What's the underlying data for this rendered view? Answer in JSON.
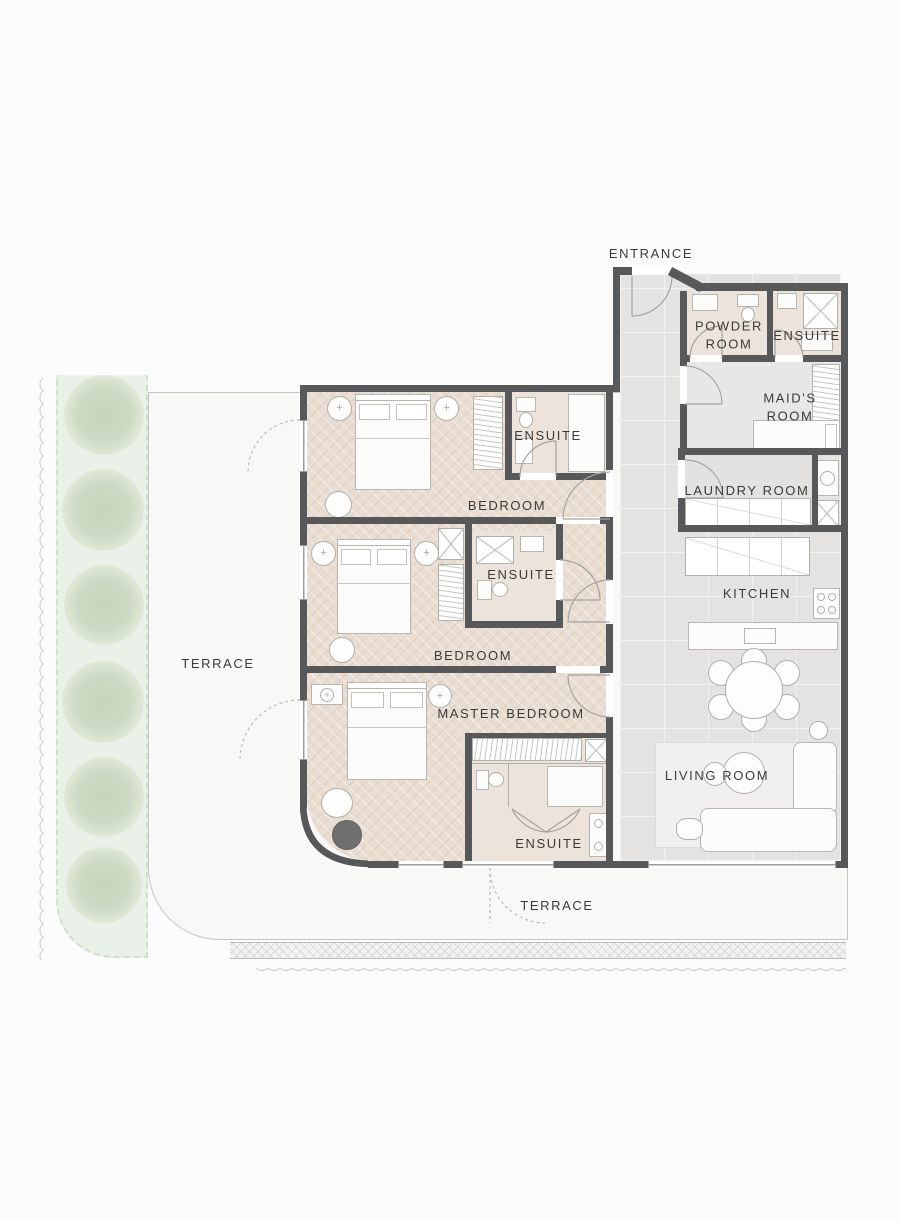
{
  "plan": {
    "type": "apartment-floor-plan",
    "labels": {
      "entrance": "ENTRANCE",
      "powder_room": "POWDER ROOM",
      "ensuite_top": "ENSUITE",
      "maids_room": "MAID'S ROOM",
      "laundry_room": "LAUNDRY ROOM",
      "kitchen": "KITCHEN",
      "ensuite_bedroom1": "ENSUITE",
      "bedroom1": "BEDROOM",
      "ensuite_bedroom2": "ENSUITE",
      "bedroom2": "BEDROOM",
      "master_bedroom": "MASTER BEDROOM",
      "living_room": "LIVING ROOM",
      "ensuite_master": "ENSUITE",
      "terrace_left": "TERRACE",
      "terrace_bottom": "TERRACE"
    },
    "colors": {
      "wall": "#57585a",
      "wood_floor": "#e9ddd1",
      "bath_floor": "#ece3da",
      "tile_floor": "#e4e3e1",
      "terrace": "#f8f8f6",
      "greenery": "#eaf1e9",
      "tree": "#ccd9c4",
      "label_text": "#3b3b3b"
    }
  }
}
